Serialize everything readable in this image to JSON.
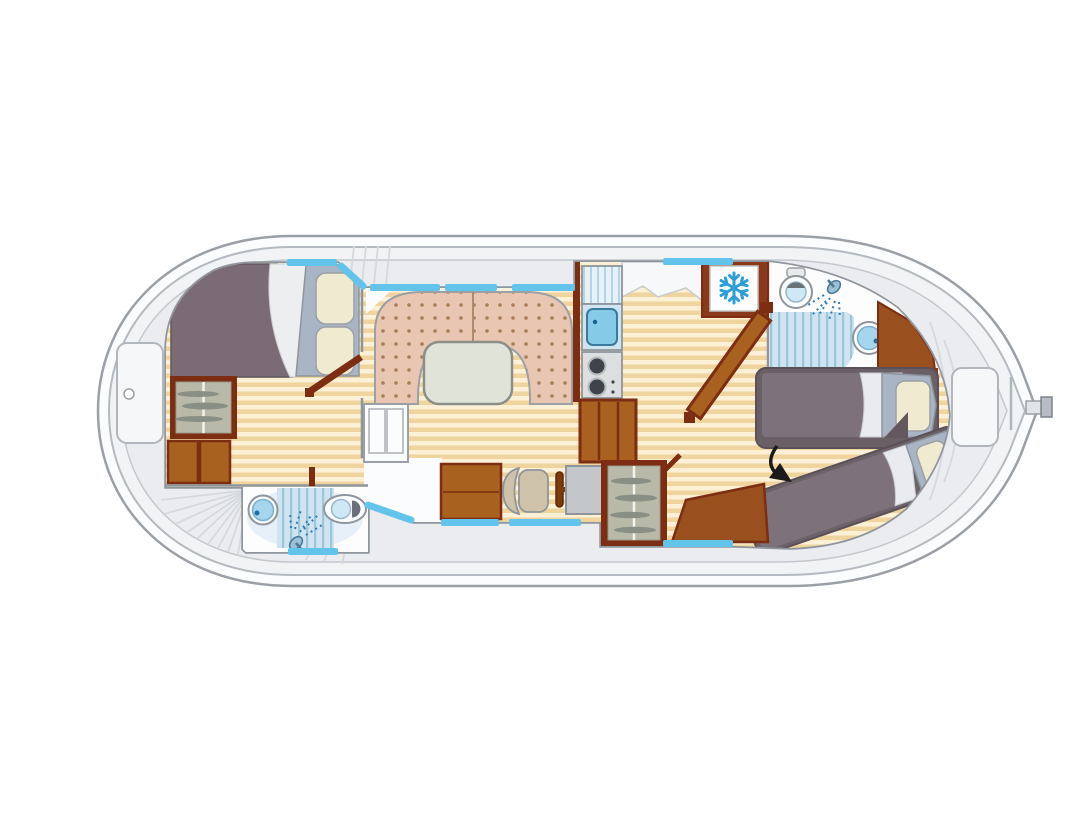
{
  "page": {
    "background": "#ffffff",
    "type": "boat-deck-floor-plan"
  },
  "colors": {
    "hull_outline": "#9aa0a6",
    "hull_fill": "#fbfcfd",
    "band_fill": "#f1f3f5",
    "deck_fill": "#eaecef",
    "wall_stroke": "#8e959c",
    "interior_white": "#fdfdfe",
    "wood_light": "#fcf0d6",
    "wood_dark": "#f0d49e",
    "sofa_base": "#e9c6b2",
    "sofa_dot": "#a87c55",
    "table_fill": "#dfe3d8",
    "bed_blanket": "#7b6b74",
    "bed_mattress": "#7e727a",
    "headboard": "#a9b5c5",
    "pillow": "#f0ead0",
    "wood_brown": "#a8611f",
    "wood_dark_brown": "#7c2d12",
    "window_blue": "#62c4ea",
    "bath_blue": "#cfe4f0",
    "bath_stripe": "#9ec6da",
    "fixture_blue": "#a5d6ee",
    "accent_blue": "#2b9fd8",
    "console_gray": "#c3c7cc",
    "chair_tan": "#cfc2ab",
    "dark_fixture": "#6a7078",
    "annotation": "#1a1a1a"
  },
  "plan": {
    "vessel": "canal-cruiser-deck-plan",
    "areas": [
      {
        "name": "bow-deck",
        "fixtures": [
          "deck-hatch",
          "radial-deck-steps"
        ]
      },
      {
        "name": "front-cabin",
        "fixtures": [
          "double-bed",
          "pillows",
          "wardrobe",
          "storage-cabinets",
          "cabin-door"
        ]
      },
      {
        "name": "front-bathroom",
        "fixtures": [
          "washbasin",
          "shower",
          "toilet"
        ]
      },
      {
        "name": "saloon",
        "fixtures": [
          "u-shaped-dinette",
          "dining-table",
          "companionway-steps"
        ]
      },
      {
        "name": "galley",
        "fixtures": [
          "draining-board",
          "sink",
          "two-burner-stove",
          "steps"
        ]
      },
      {
        "name": "helm-station",
        "fixtures": [
          "bench",
          "helm-seat",
          "steering-wheel",
          "console",
          "wardrobe"
        ]
      },
      {
        "name": "aft-bathroom",
        "fixtures": [
          "toilet",
          "shower",
          "washbasin",
          "corner-cabinet"
        ]
      },
      {
        "name": "galley-aft",
        "fixtures": [
          "refrigerator",
          "snowflake-icon"
        ]
      },
      {
        "name": "aft-cabin",
        "fixtures": [
          "single-bed",
          "angled-single-bed",
          "cabin-door",
          "arrow-annotation"
        ]
      },
      {
        "name": "stern-deck",
        "fixtures": [
          "deck-hatch",
          "transom-line",
          "rudder-tiller"
        ]
      }
    ]
  }
}
